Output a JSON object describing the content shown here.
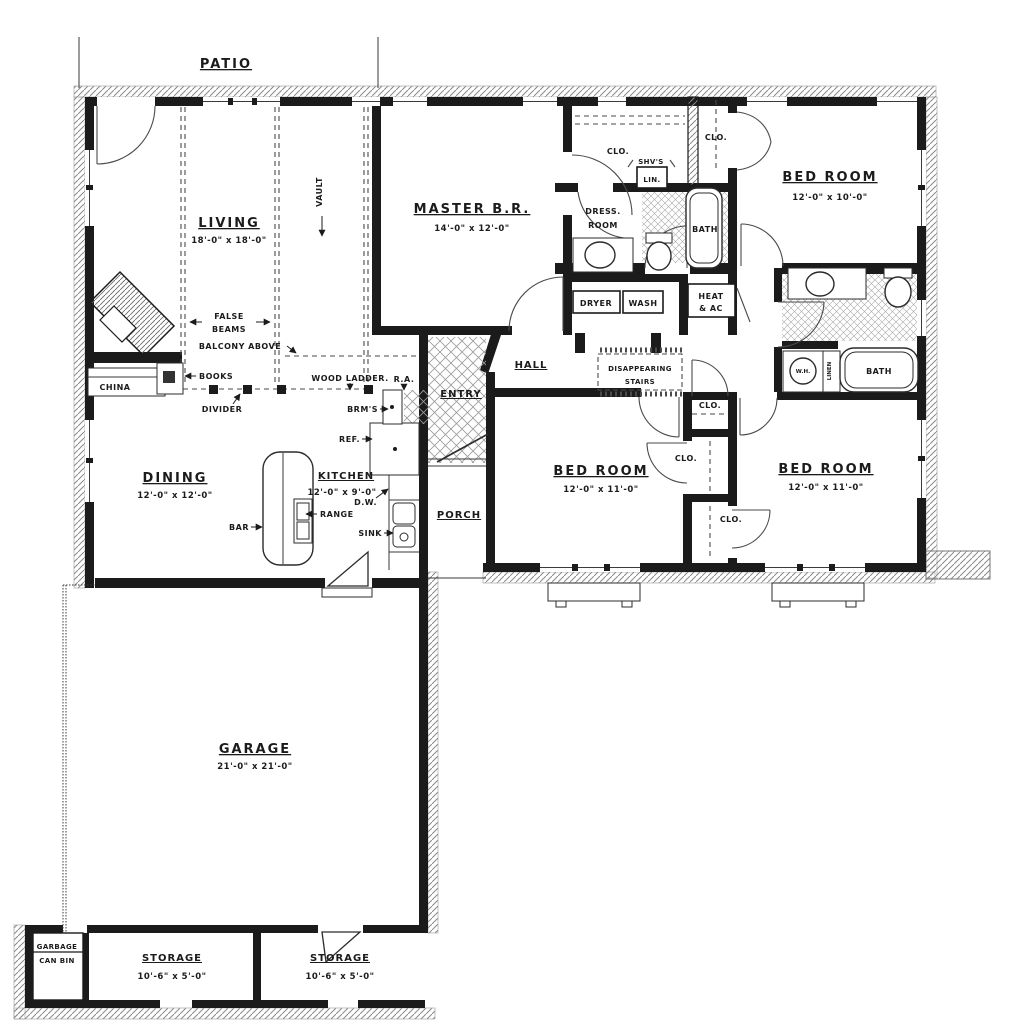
{
  "rooms": {
    "patio": {
      "name": "PATIO"
    },
    "living": {
      "name": "LIVING",
      "dims": "18'-0\" x 18'-0\""
    },
    "master_bedroom": {
      "name": "MASTER B.R.",
      "dims": "14'-0\" x 12'-0\""
    },
    "bedroom_top_right": {
      "name": "BED ROOM",
      "dims": "12'-0\" x 10'-0\""
    },
    "bedroom_middle": {
      "name": "BED ROOM",
      "dims": "12'-0\" x 11'-0\""
    },
    "bedroom_right": {
      "name": "BED ROOM",
      "dims": "12'-0\" x 11'-0\""
    },
    "dining": {
      "name": "DINING",
      "dims": "12'-0\" x 12'-0\""
    },
    "kitchen": {
      "name": "KITCHEN",
      "dims": "12'-0\" x 9'-0\""
    },
    "garage": {
      "name": "GARAGE",
      "dims": "21'-0\" x 21'-0\""
    },
    "storage_left": {
      "name": "STORAGE",
      "dims": "10'-6\" x 5'-0\""
    },
    "storage_right": {
      "name": "STORAGE",
      "dims": "10'-6\" x 5'-0\""
    },
    "hall": {
      "name": "HALL"
    },
    "entry": {
      "name": "ENTRY"
    },
    "porch": {
      "name": "PORCH"
    },
    "dress_room": {
      "line1": "DRESS.",
      "line2": "ROOM"
    },
    "bath_1": {
      "name": "BATH"
    },
    "bath_2": {
      "name": "BATH"
    }
  },
  "labels": {
    "vault": "VAULT",
    "clo": "CLO.",
    "shvs": "SHV'S",
    "lin": "LIN.",
    "dryer": "DRYER",
    "wash": "WASH",
    "heat_ac_line1": "HEAT",
    "heat_ac_line2": "& AC",
    "stairs_line1": "DISAPPEARING",
    "stairs_line2": "STAIRS",
    "false_beams_line1": "FALSE",
    "false_beams_line2": "BEAMS",
    "balcony_above": "BALCONY ABOVE",
    "books": "BOOKS",
    "china": "CHINA",
    "divider": "DIVIDER",
    "wood_ladder": "WOOD LADDER.",
    "return_air": "R.A.",
    "brooms": "BRM'S",
    "refrigerator": "REF.",
    "dishwasher": "D.W.",
    "range": "RANGE",
    "sink": "SINK",
    "bar": "BAR",
    "water_heater": "W.H.",
    "linen": "LINEN",
    "garbage_line1": "GARBAGE",
    "garbage_line2": "CAN BIN"
  },
  "colors": {
    "ink": "#1b1b1b",
    "paper": "#ffffff",
    "hatch": "#8a8a8a"
  }
}
